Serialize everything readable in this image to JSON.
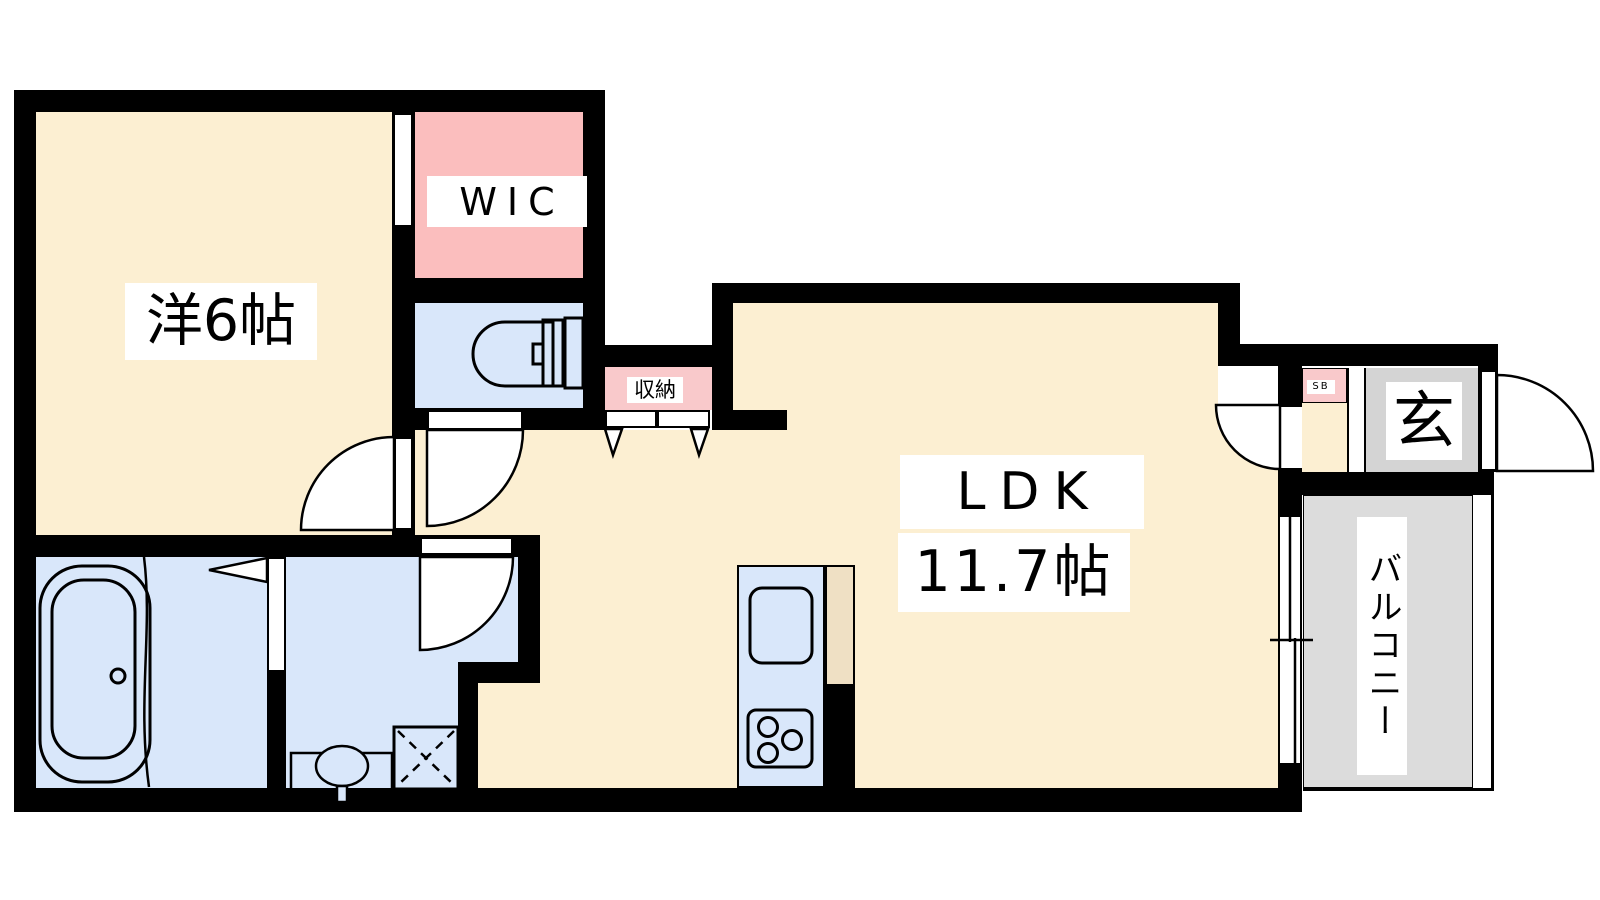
{
  "rooms": {
    "bedroom": {
      "label": "洋6帖"
    },
    "wic": {
      "label": "WIC"
    },
    "storage": {
      "label": "収納"
    },
    "ldk": {
      "label": "LDK",
      "size": "11.7帖"
    },
    "shoe_box": {
      "label": "SB"
    },
    "entrance": {
      "label": "玄"
    },
    "balcony": {
      "label": "バルコニー"
    }
  },
  "colors": {
    "floor_cream": "#FCEFD2",
    "wic_pink": "#FBBEBE",
    "storage_pink": "#F9C9CB",
    "water_blue": "#D9E7FA",
    "entrance_gray": "#D4D4D4",
    "balcony_gray": "#DCDCDC",
    "counter_tan": "#EFE0C4",
    "wall_black": "#000000"
  }
}
